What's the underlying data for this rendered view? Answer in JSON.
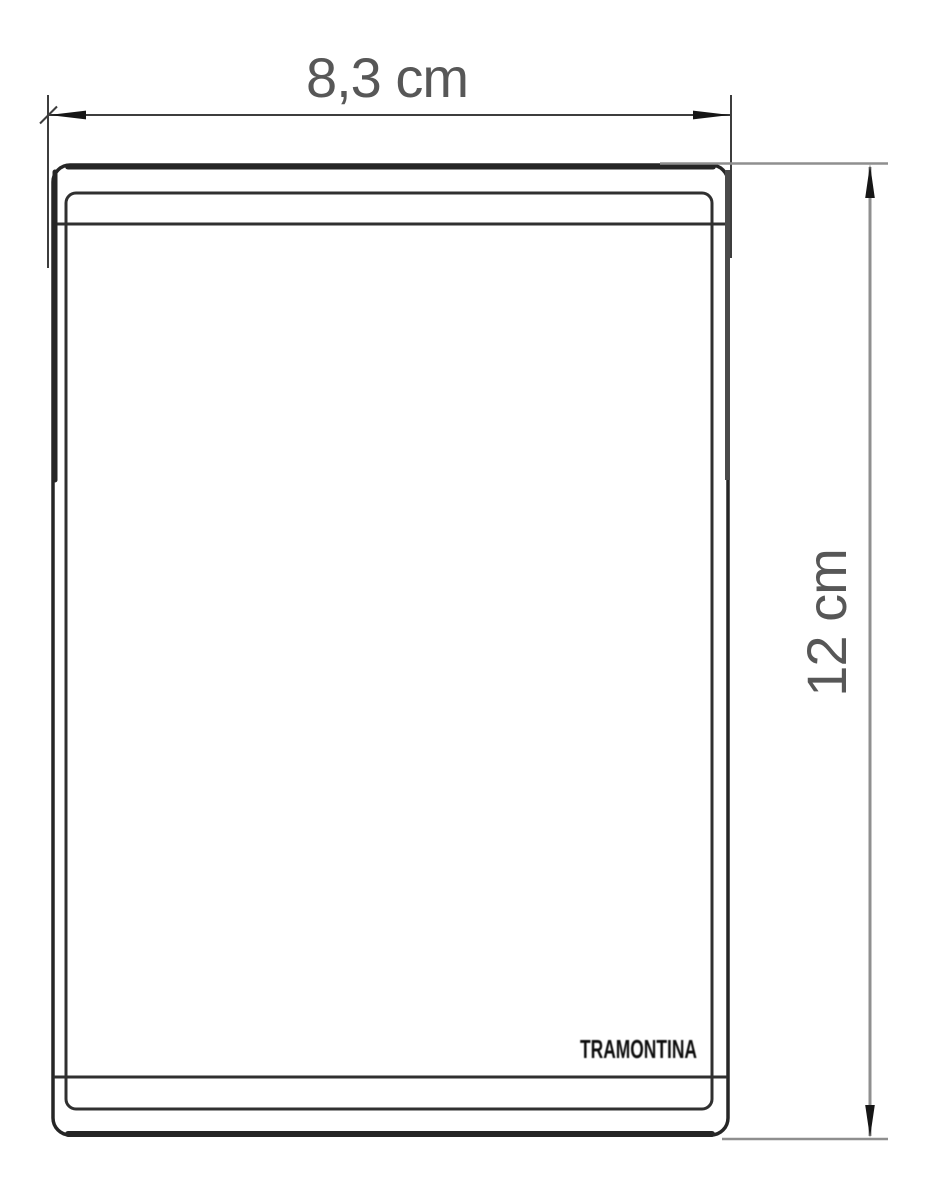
{
  "labels": {
    "width": "8,3 cm",
    "height": "12 cm"
  },
  "brand": "TRAMONTINA",
  "colors": {
    "background": "#ffffff",
    "plate_outline": "#262626",
    "plate_detail": "#303030",
    "edge_shade": "#4a4a4a",
    "dimension_line": "#3d3d3d",
    "extension_line": "#8f8f8f",
    "arrow": "#161616",
    "label_text": "#575757",
    "brand_text": "#0c0c0c"
  }
}
